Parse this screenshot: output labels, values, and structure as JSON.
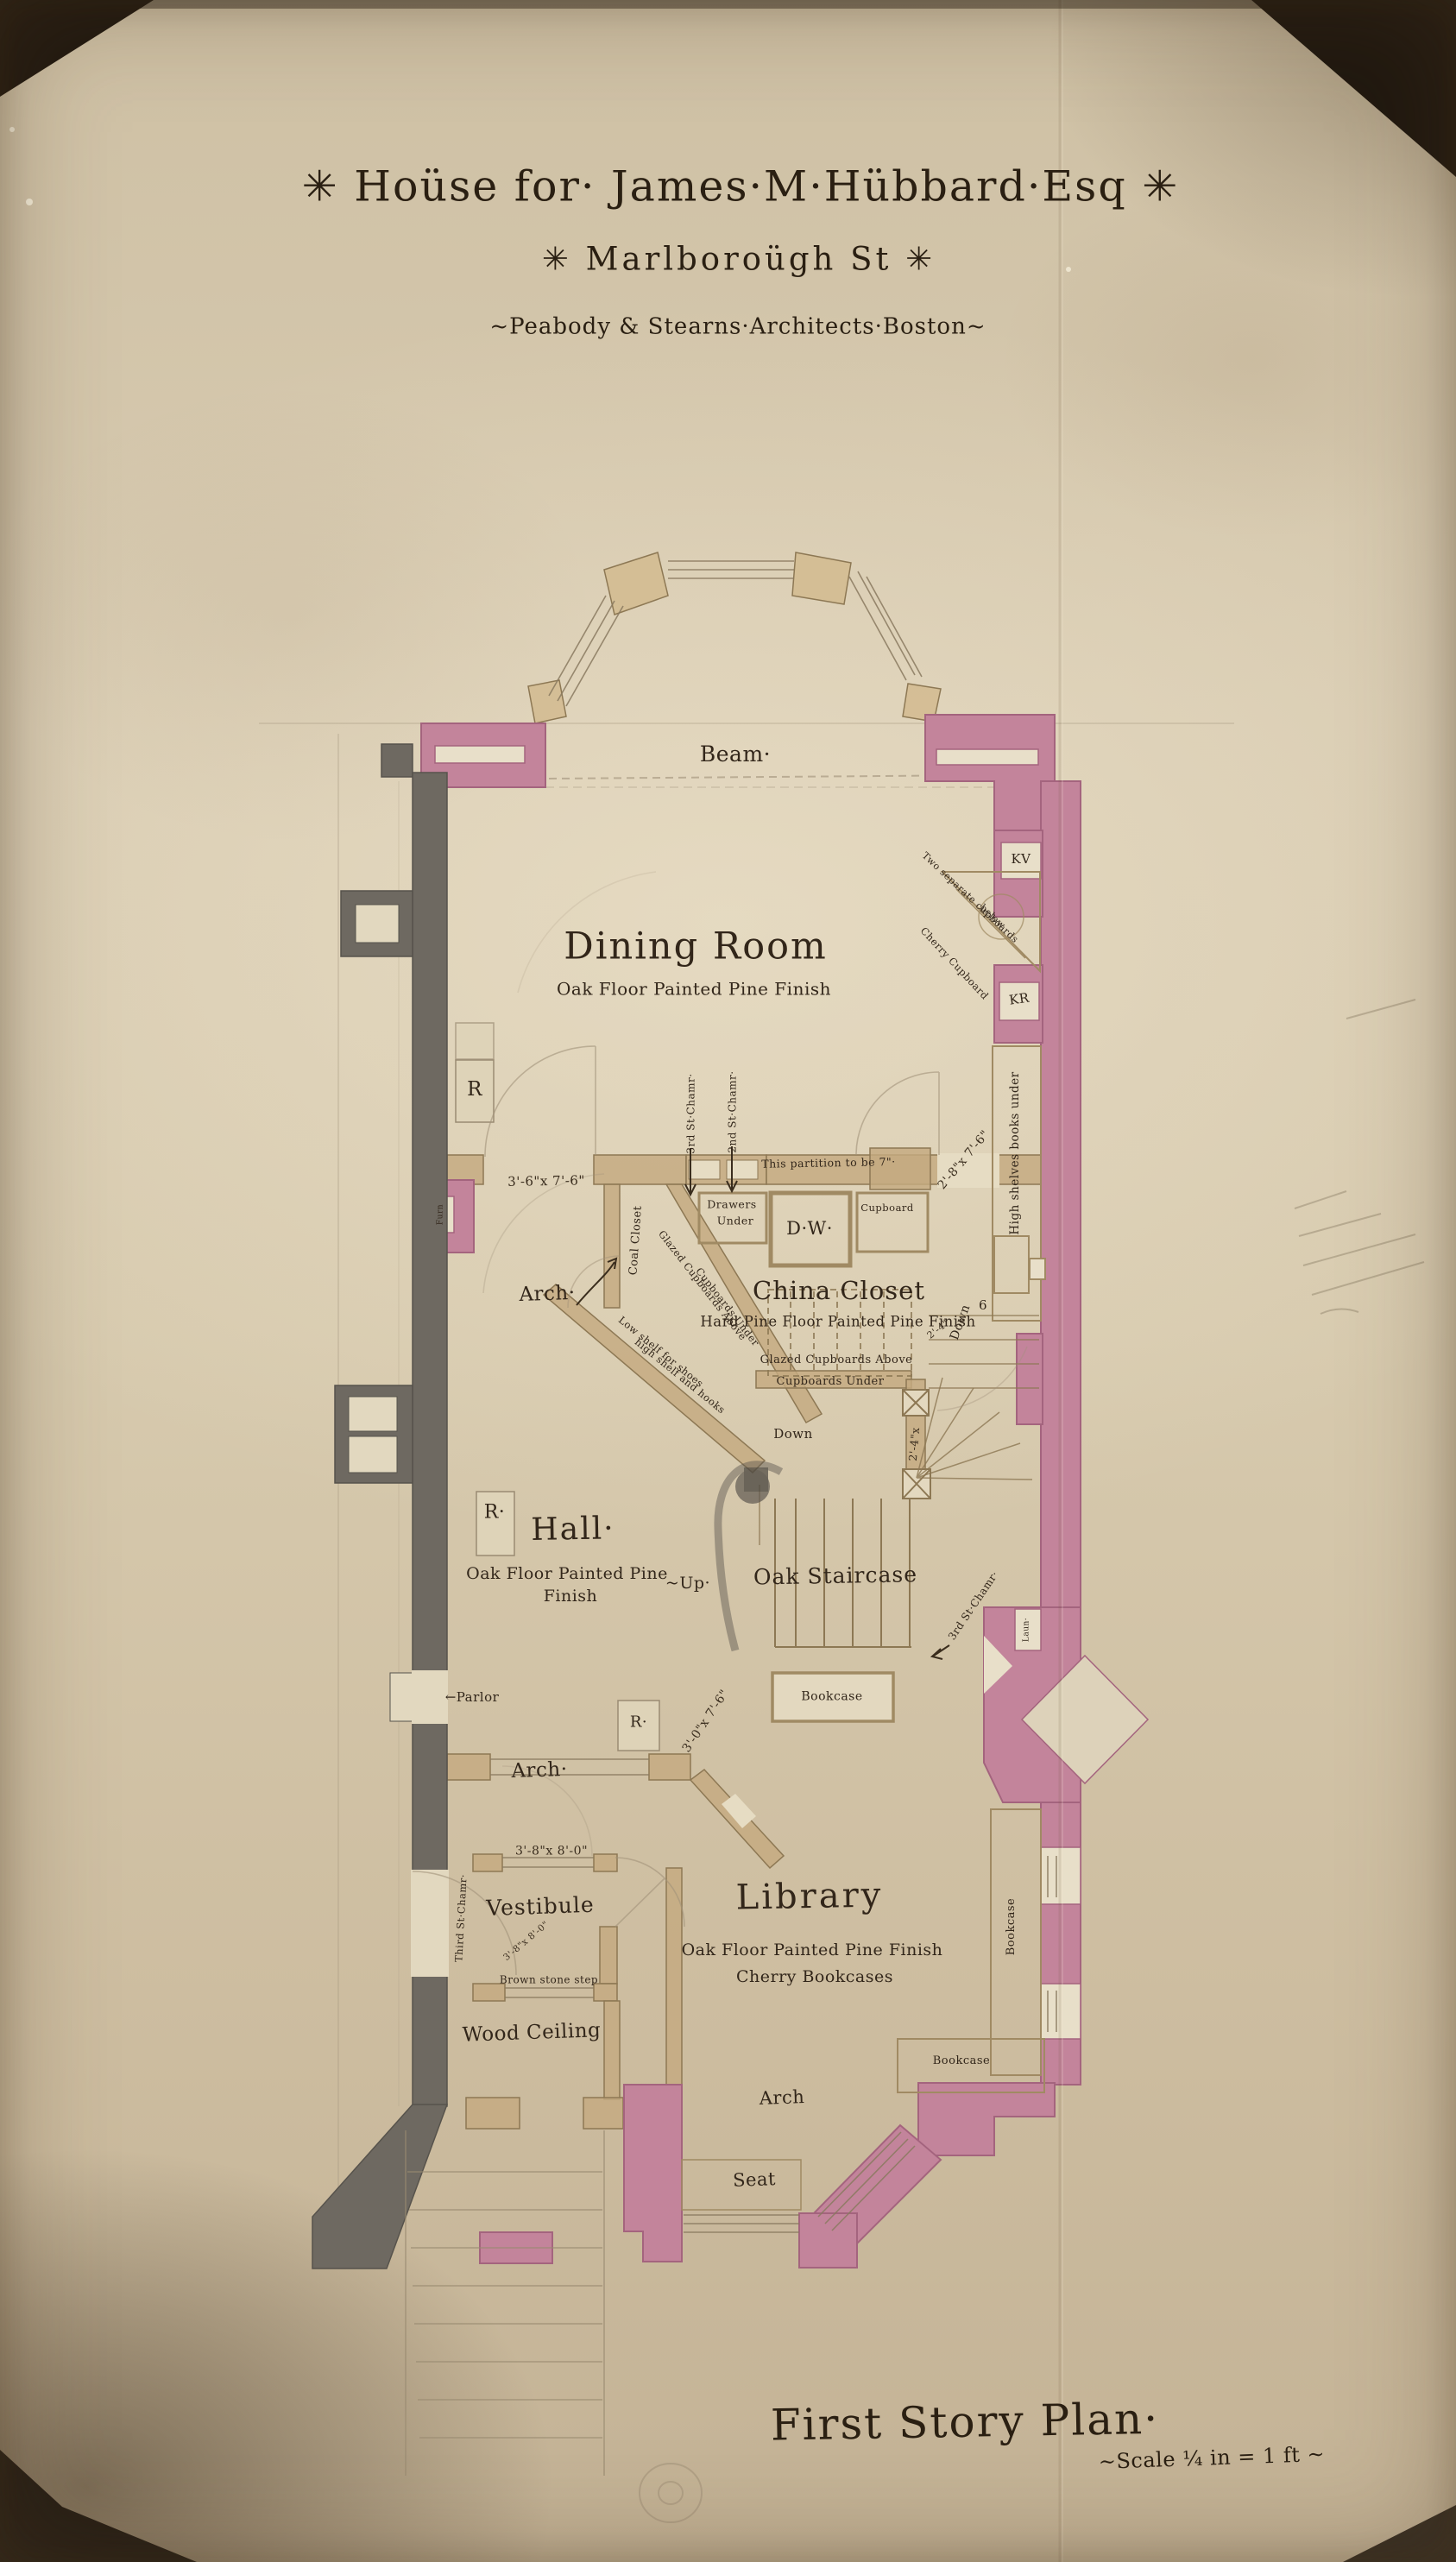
{
  "title_block": {
    "line1": "✳ Hoüse for· James·M·Hübbard·Esq ✳",
    "line2": "✳ Marlboroügh St ✳",
    "line3": "~Peabody & Stearns·Architects·Boston~"
  },
  "footer": {
    "plan_title": "First Story Plan·",
    "scale": "~Scale ¼ in = 1 ft ~"
  },
  "rooms": {
    "dining_room": {
      "name": "Dining Room",
      "finish": "Oak Floor Painted Pine Finish"
    },
    "china_closet": {
      "name": "China Closet",
      "finish": "Hard Pine Floor Painted Pine Finish"
    },
    "hall": {
      "name": "Hall·",
      "finish_1": "Oak Floor Painted Pine",
      "finish_2": "Finish"
    },
    "staircase": {
      "name": "Oak Staircase"
    },
    "library": {
      "name": "Library",
      "finish": "Oak Floor Painted Pine Finish",
      "bookcases": "Cherry Bookcases"
    },
    "vestibule": {
      "name": "Vestibule"
    }
  },
  "annotations": {
    "beam": "Beam·",
    "two_separate_cupboards": "Two separate cupboards",
    "below": "below",
    "cherry_cupboard": "Cherry Cupboard",
    "kv": "KV",
    "kr": "KR",
    "register": "R",
    "register_dot": "R·",
    "high_shelves": "High shelves books under",
    "cupboard": "Cupboard",
    "third_story_chamber": "3rd St·Chamr·",
    "second_story_chamber": "2nd St·Chamr·",
    "partition_note": "This partition to be 7\"·",
    "coal_closet": "Coal Closet",
    "drawers": "Drawers",
    "under": "Under",
    "dumbwaiter": "D·W·",
    "glazed_above": "Glazed Cupboards Above",
    "cupboards_under": "Cupboards Under",
    "low_shelf": "Low shelf for shoes",
    "high_shelf": "high shelf and hooks",
    "arch": "Arch·",
    "arch_plain": "Arch",
    "down": "Down",
    "down_count": "6",
    "up": "~Up·",
    "parlor": "←Parlor",
    "bookcase": "Bookcase",
    "laundry_flue": "Laun·",
    "furnace_flue": "Furn",
    "brown_stone_step": "Brown stone step",
    "third_story_chamber_full": "Third St·Chamr·",
    "wood_ceiling": "Wood Ceiling",
    "seat": "Seat"
  },
  "dimensions": {
    "d_2_8": "2'-8\"x 7'-6\"",
    "d_3_6": "3'-6\"x 7'-6\"",
    "d_2_4_v": "2'-4\"x",
    "d_2_4": "2'-4\"",
    "d_3_0": "3'-0\"x 7'-6\"",
    "d_3_8": "3'-8\"x 8'-0\""
  },
  "colors": {
    "paper": "#d5c8ae",
    "ink": "#2f2518",
    "pencil": "#9a8b73",
    "masonry_pink": "#c3849b",
    "party_wall_gray": "#6e6961",
    "partition_tan": "#c4aa80",
    "photo_background": "#20180f"
  }
}
